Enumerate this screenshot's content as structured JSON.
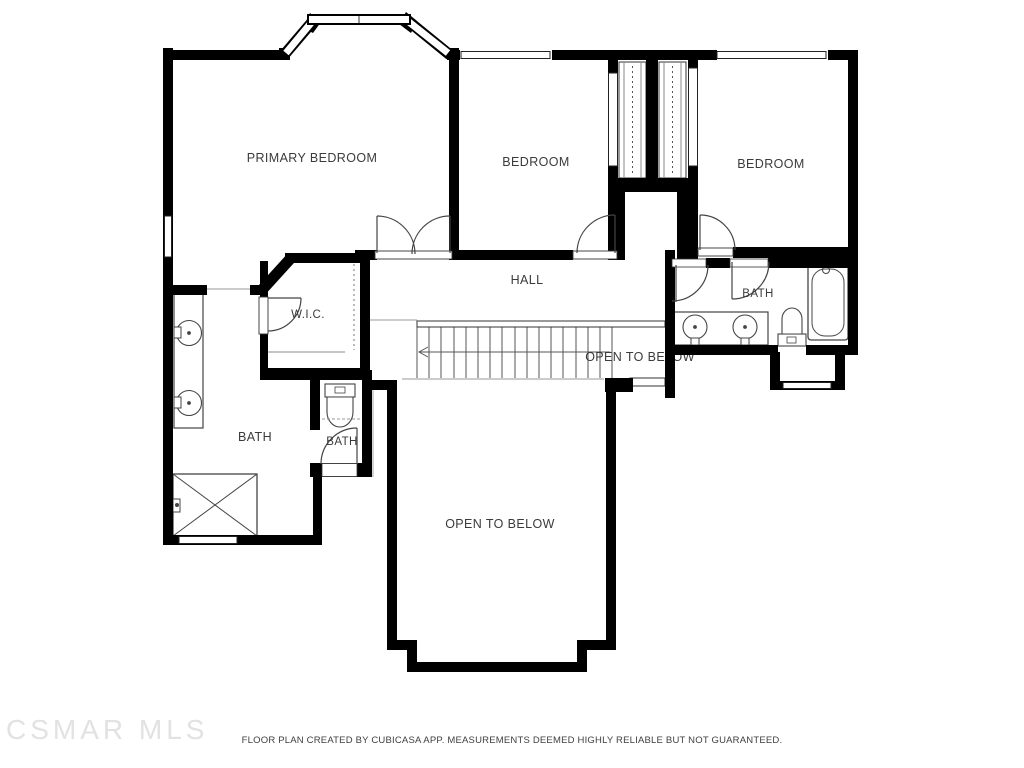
{
  "plan": {
    "rooms": {
      "primary_bedroom": "PRIMARY BEDROOM",
      "bedroom_center": "BEDROOM",
      "bedroom_right": "BEDROOM",
      "hall": "HALL",
      "wic": "W.I.C.",
      "bath_ensuite": "BATH",
      "bath_primary": "BATH",
      "bath_small": "BATH",
      "open_below_stairwell": "OPEN TO BELOW",
      "open_below_main": "OPEN TO BELOW"
    },
    "fixtures": [
      "bay-window",
      "staircase",
      "shower",
      "double-sink-vanity",
      "toilet",
      "bathtub",
      "closet-sliding-doors"
    ],
    "colors": {
      "wall": "#000000",
      "label": "#3b3b3b",
      "fixture_line": "#444444",
      "light_line": "#999999",
      "watermark": "#e2e2e2",
      "background": "#ffffff"
    }
  },
  "watermark": {
    "text": "CSMAR MLS"
  },
  "footer": {
    "disclaimer": "FLOOR PLAN CREATED BY CUBICASA APP. MEASUREMENTS DEEMED HIGHLY RELIABLE BUT NOT GUARANTEED."
  }
}
